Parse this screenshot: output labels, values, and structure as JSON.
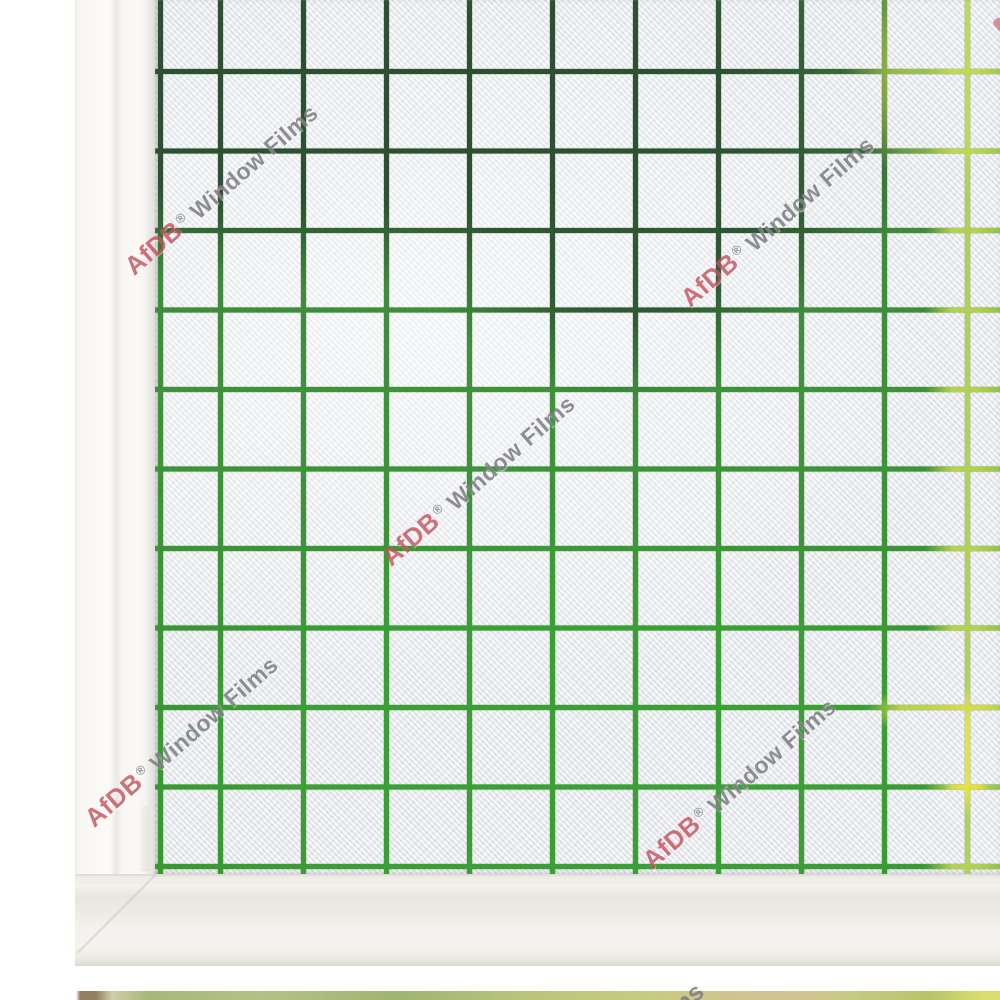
{
  "watermark": {
    "brand": "AfDB",
    "registered_mark": "®",
    "product": "Window Films",
    "full_text": "AfDB® Window Films",
    "angle_deg": -41,
    "instances": [
      {
        "id": "top-left",
        "x": 222,
        "y": 190
      },
      {
        "id": "top-right",
        "x": 778,
        "y": 222
      },
      {
        "id": "center",
        "x": 479,
        "y": 481
      },
      {
        "id": "bottom-left",
        "x": 182,
        "y": 742
      },
      {
        "id": "bottom-right",
        "x": 740,
        "y": 784
      }
    ],
    "partial_instances": [
      {
        "id": "bottom-edge-films",
        "text": "Films",
        "x": 676,
        "y": 1010
      },
      {
        "id": "right-edge-red-piece",
        "text": "",
        "x": 997,
        "y": 18
      }
    ]
  },
  "film_pattern": {
    "type": "frosted-squares-grid",
    "cell_px": {
      "width": 83,
      "height": 79.5
    },
    "line_width_px": 5,
    "line_colors": {
      "dark_green": "#2e4f33",
      "green": "#3f913c",
      "bright_green": "#38992f",
      "yellow_green": "#c9dc55",
      "yellow": "#e8e03c"
    }
  },
  "colors": {
    "brand_red": "#c4515c",
    "watermark_gray": "#807f85",
    "grid_dark_green": "#2e4f33",
    "grid_green": "#3f913c",
    "grid_bright_green": "#38992f",
    "grid_yellow_green": "#c9dc55",
    "grid_yellow": "#e8e03c",
    "frame_white": "#faf8f5",
    "wall_white": "#ffffff",
    "glass_frost": "#f0f1f4"
  }
}
